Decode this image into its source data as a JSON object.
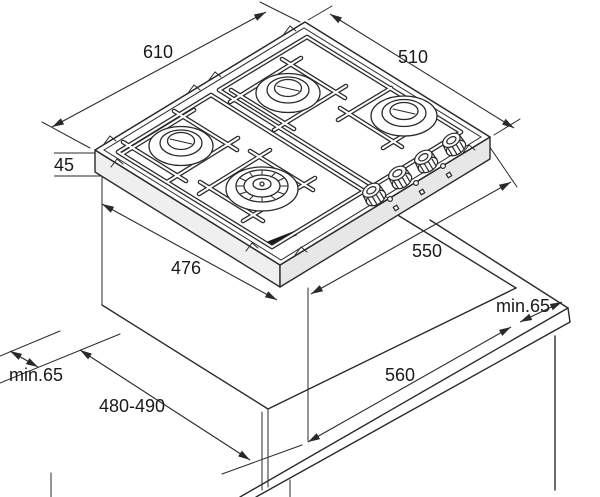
{
  "dimensions": {
    "hob_width": "610",
    "hob_depth": "510",
    "hob_height": "45",
    "body_depth": "476",
    "body_width": "550",
    "cutout_width": "560",
    "cutout_depth": "480-490",
    "clearance_left": "min.65",
    "clearance_right": "min.65"
  },
  "style": {
    "background": "#ffffff",
    "line_color": "#2a2a2a",
    "text_color": "#1a1a1a"
  },
  "drawing": {
    "subject": "built-in 4-burner gas hob installation drawing",
    "burner_count": 4,
    "knob_count": 4
  }
}
